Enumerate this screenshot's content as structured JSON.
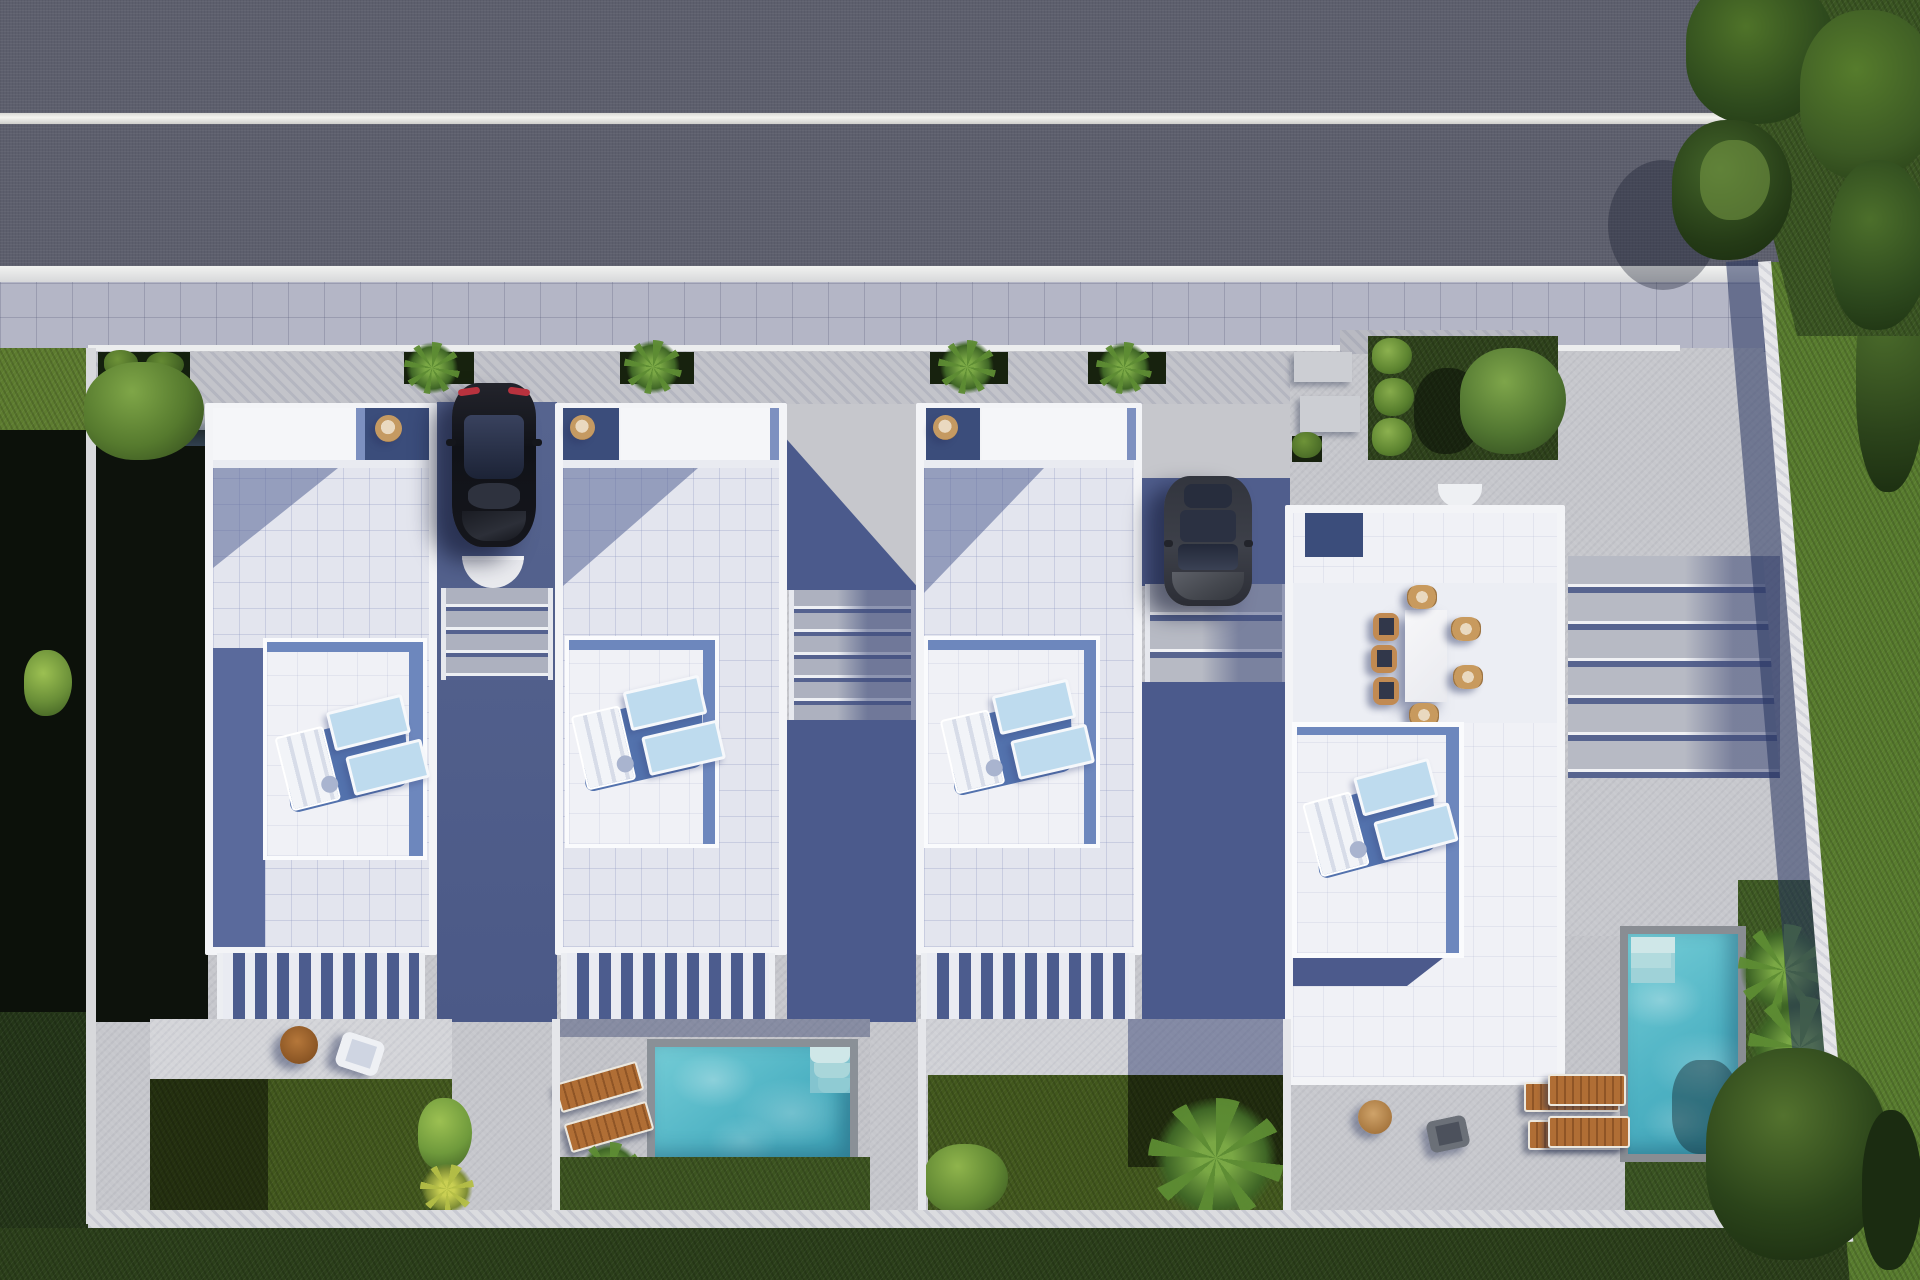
{
  "scene": {
    "title": "Aerial 3D architectural rendering of a row of four modern white villas",
    "view": "top-down drone view, afternoon sun from upper right, long blue shadows to lower left",
    "palette": {
      "asphalt": "#5d5f6d",
      "road_line": "#f2f2ee",
      "sidewalk_tile": "#b4b6c6",
      "concrete_light": "#c7c8cd",
      "concrete_shadow_blue": "#4f5d8c",
      "house_parapet_white": "#f3f4f7",
      "roof_tile": "#e3e5ee",
      "terrace_white": "#f0f1f6",
      "shadow_band_blue": "#6d87bd",
      "lounger_mat_blue": "#bedbee",
      "pool_water": "#5fbfcd",
      "pool_rim_gray": "#8a9097",
      "wood_brown": "#b06e35",
      "lawn_green": "#42581d",
      "lawn_bright": "#5a7f30",
      "lawn_shadow": "#0d120c",
      "tree_green": "#2e4a1d",
      "car_black": "#17191f",
      "car_gray": "#3d4049",
      "taillight_red": "#b8323e",
      "boundary_wall_white": "#e7e7ea"
    },
    "road": {
      "lanes": 2,
      "marking_lines": 2,
      "sidewalk": "tiled, runs along bottom edge of road"
    },
    "villas": [
      {
        "id": "villa-1",
        "position": "far left",
        "roof": "white flat roof with tiled deck",
        "terrace": "raised white terrace with 2 blue lounger mats, folded white loungers and side table",
        "garden": "lawn with round wooden table and white armchair, pergola slats"
      },
      {
        "id": "villa-2",
        "position": "second from left",
        "terrace": "raised white terrace with 2 blue lounger mats",
        "garden": "turquoise pool with corner steps and 2 wooden sun loungers, ferns"
      },
      {
        "id": "villa-3",
        "position": "third from left",
        "terrace": "raised white terrace with 2 blue lounger mats",
        "garden": "lawn with large palm plant, partly in shadow"
      },
      {
        "id": "villa-4",
        "position": "far right, largest",
        "terrace": "open roof terrace with white dining table and 7 wicker chairs plus 2 blue lounger mats",
        "garden": "deck with loungers, round table and vertical turquoise pool with palm plants"
      }
    ],
    "vehicles": [
      {
        "id": "car-1",
        "color": "black",
        "detail": "red taillights, parked nose-down between villa 1 and 2"
      },
      {
        "id": "car-2",
        "color": "dark gray",
        "detail": "parked nose-down between villa 3 and 4"
      }
    ],
    "stairs": [
      "steps below car 1",
      "steps between villa 2 and 3",
      "steps between villa 3 and 4",
      "wide terraced steps right of villa 4"
    ],
    "landscape": {
      "left": "deeply shadowed side garden with trees",
      "right": "sunlit lawn behind diagonal white boundary wall, large trees",
      "top_right": "tree cluster overhanging road",
      "bottom": "white boundary wall with dark lawn strip"
    }
  }
}
